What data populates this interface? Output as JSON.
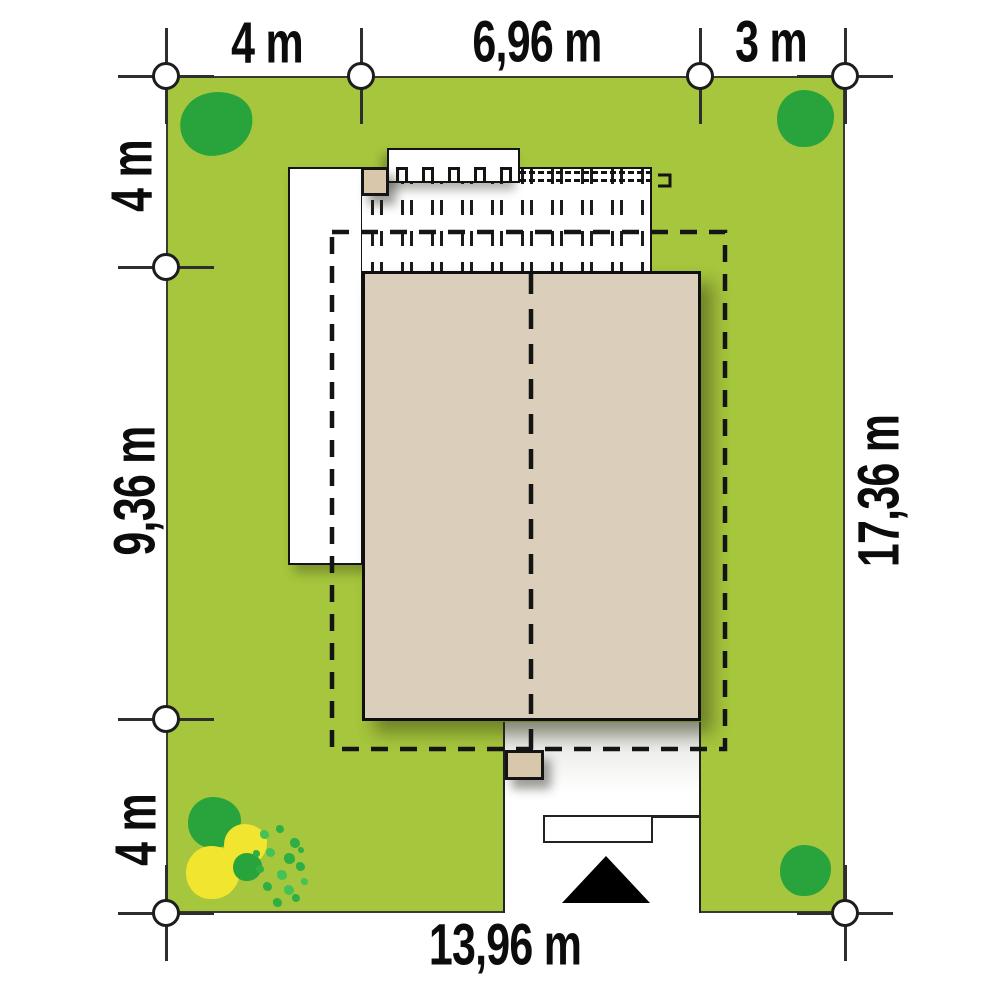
{
  "dims": {
    "top": [
      "4 m",
      "6,96 m",
      "3 m"
    ],
    "left": [
      "4 m",
      "9,36 m",
      "4 m"
    ],
    "right": [
      "17,36 m"
    ],
    "bottom": [
      "13,96 m"
    ]
  },
  "colors": {
    "grass": "#a6c63d",
    "roof": "#dbceba",
    "tree_green": "#29a43d",
    "shrub_green": "#2fae44",
    "tree_yellow": "#f2e52f",
    "line_black": "#141414",
    "paving_white": "#ffffff"
  },
  "symbols": {
    "entrance_arrow": "black triangle marking plot entrance/driveway",
    "dimension_marker": "white circle survey point",
    "dashed_rectangle": "roof eaves outline",
    "hatched_area": "pergola over terrace"
  }
}
